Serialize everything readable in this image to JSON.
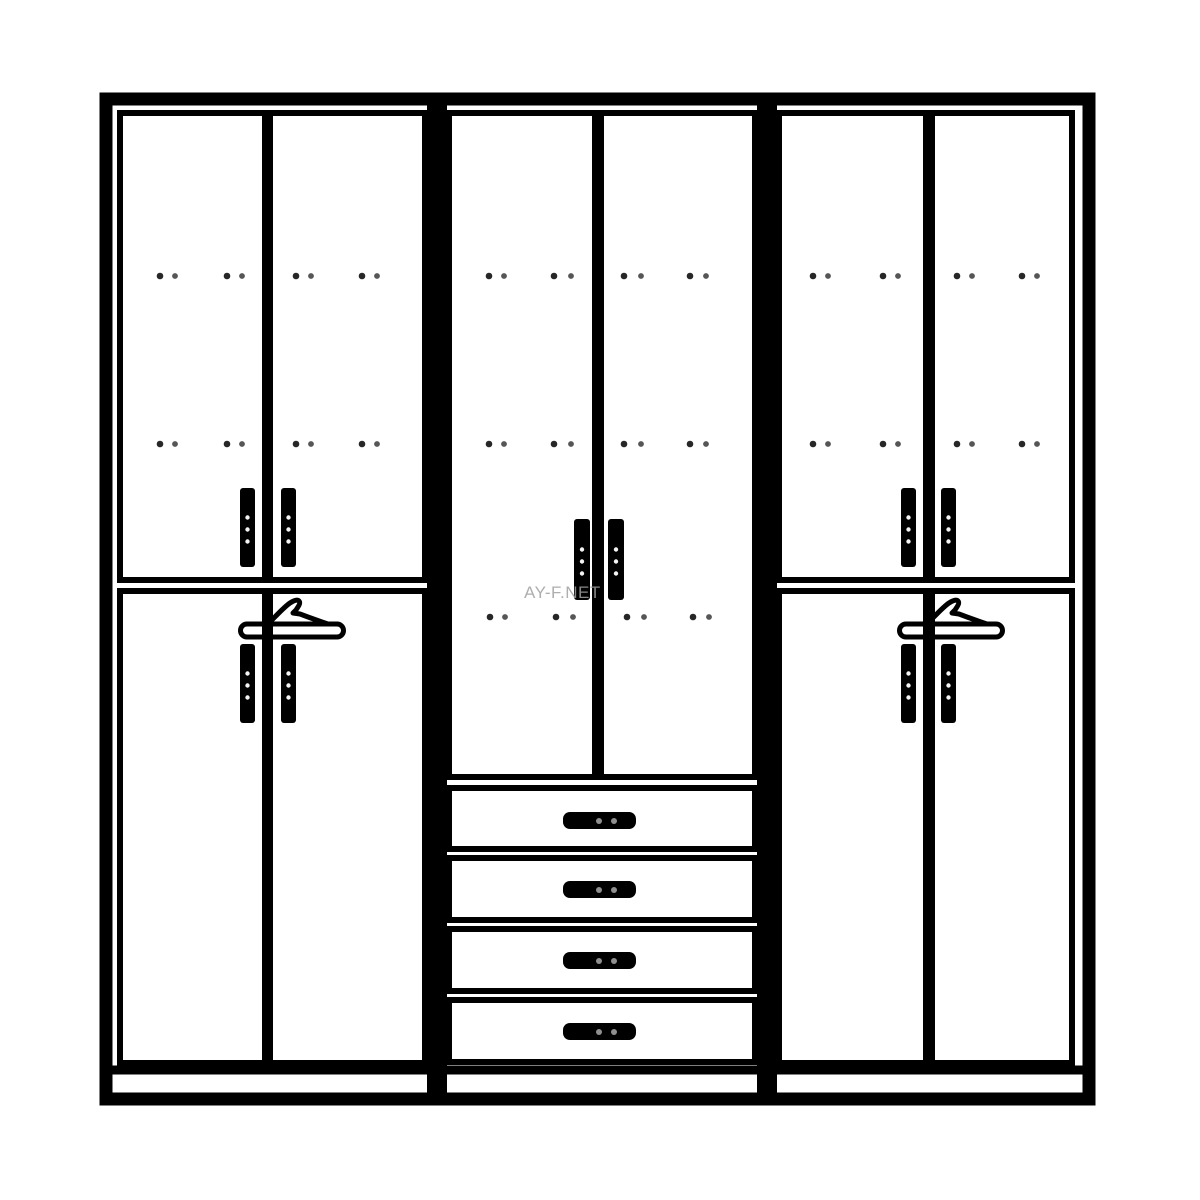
{
  "watermark": {
    "text": "AY-F.NET",
    "x": 524,
    "y": 584,
    "font_size": 17,
    "color": "#a0a0a0"
  },
  "colors": {
    "background": "#ffffff",
    "line": "#000000",
    "hinge_dot": "#151515",
    "handle_dot_light": "#f4f4f4",
    "drawer_handle_dot": "#8f8f8f"
  },
  "diagram": {
    "type": "wardrobe-front-elevation",
    "canvas": {
      "width": 1200,
      "height": 1200
    },
    "frame": {
      "name": "outer-frame",
      "x": 106,
      "y": 99,
      "w": 983,
      "h": 1000,
      "sw": 13
    },
    "dividers": [
      {
        "name": "section-divider-left",
        "x": 427,
        "y": 99,
        "w": 20,
        "h": 1000
      },
      {
        "name": "section-divider-right",
        "x": 757,
        "y": 99,
        "w": 20,
        "h": 1000
      }
    ],
    "plinth": {
      "name": "plinth-top-line",
      "x1": 106,
      "x2": 1089,
      "y": 1070,
      "sw": 9
    },
    "door_stroke": 6,
    "doors": [
      {
        "name": "door-left-upper-left",
        "x": 120,
        "y": 113,
        "w": 145,
        "h": 467
      },
      {
        "name": "door-left-upper-right",
        "x": 270,
        "y": 113,
        "w": 155,
        "h": 467
      },
      {
        "name": "door-left-lower-left",
        "x": 120,
        "y": 591,
        "w": 145,
        "h": 472
      },
      {
        "name": "door-left-lower-right",
        "x": 270,
        "y": 591,
        "w": 155,
        "h": 472
      },
      {
        "name": "door-middle-left",
        "x": 449,
        "y": 113,
        "w": 146,
        "h": 664
      },
      {
        "name": "door-middle-right",
        "x": 601,
        "y": 113,
        "w": 154,
        "h": 664
      },
      {
        "name": "door-right-upper-left",
        "x": 779,
        "y": 113,
        "w": 147,
        "h": 467
      },
      {
        "name": "door-right-upper-right",
        "x": 932,
        "y": 113,
        "w": 140,
        "h": 467
      },
      {
        "name": "door-right-lower-left",
        "x": 779,
        "y": 591,
        "w": 147,
        "h": 472
      },
      {
        "name": "door-right-lower-right",
        "x": 932,
        "y": 591,
        "w": 140,
        "h": 472
      }
    ],
    "drawers": [
      {
        "name": "drawer-1",
        "x": 449,
        "y": 788,
        "w": 306,
        "h": 61
      },
      {
        "name": "drawer-2",
        "x": 449,
        "y": 858,
        "w": 306,
        "h": 62
      },
      {
        "name": "drawer-3",
        "x": 449,
        "y": 929,
        "w": 306,
        "h": 62
      },
      {
        "name": "drawer-4",
        "x": 449,
        "y": 1000,
        "w": 306,
        "h": 62
      }
    ],
    "door_handles": [
      {
        "name": "handle-left-upper-door-left",
        "x": 240,
        "y": 488,
        "w": 15,
        "h": 79
      },
      {
        "name": "handle-left-upper-door-right",
        "x": 281,
        "y": 488,
        "w": 15,
        "h": 79
      },
      {
        "name": "handle-left-lower-door-left",
        "x": 240,
        "y": 644,
        "w": 15,
        "h": 79
      },
      {
        "name": "handle-left-lower-door-right",
        "x": 281,
        "y": 644,
        "w": 15,
        "h": 79
      },
      {
        "name": "handle-middle-door-left",
        "x": 574,
        "y": 519,
        "w": 16,
        "h": 81
      },
      {
        "name": "handle-middle-door-right",
        "x": 608,
        "y": 519,
        "w": 16,
        "h": 81
      },
      {
        "name": "handle-right-upper-door-left",
        "x": 901,
        "y": 488,
        "w": 15,
        "h": 79
      },
      {
        "name": "handle-right-upper-door-right",
        "x": 941,
        "y": 488,
        "w": 15,
        "h": 79
      },
      {
        "name": "handle-right-lower-door-left",
        "x": 901,
        "y": 644,
        "w": 15,
        "h": 79
      },
      {
        "name": "handle-right-lower-door-right",
        "x": 941,
        "y": 644,
        "w": 15,
        "h": 79
      }
    ],
    "drawer_handles": [
      {
        "name": "handle-drawer-1",
        "x": 563,
        "y": 812,
        "w": 73,
        "h": 17
      },
      {
        "name": "handle-drawer-2",
        "x": 563,
        "y": 881,
        "w": 73,
        "h": 17
      },
      {
        "name": "handle-drawer-3",
        "x": 563,
        "y": 952,
        "w": 73,
        "h": 17
      },
      {
        "name": "handle-drawer-4",
        "x": 563,
        "y": 1023,
        "w": 73,
        "h": 17
      }
    ],
    "hinge_dot_rows": [
      {
        "name": "hinge-dots-row-upper",
        "y": 276,
        "pairs": [
          [
            160,
            175
          ],
          [
            227,
            242
          ],
          [
            296,
            311
          ],
          [
            362,
            377
          ],
          [
            489,
            504
          ],
          [
            554,
            571
          ],
          [
            624,
            641
          ],
          [
            690,
            706
          ],
          [
            813,
            828
          ],
          [
            883,
            898
          ],
          [
            957,
            972
          ],
          [
            1022,
            1037
          ]
        ]
      },
      {
        "name": "hinge-dots-row-middle",
        "y": 444,
        "pairs": [
          [
            160,
            175
          ],
          [
            227,
            242
          ],
          [
            296,
            311
          ],
          [
            362,
            377
          ],
          [
            489,
            504
          ],
          [
            554,
            571
          ],
          [
            624,
            641
          ],
          [
            690,
            706
          ],
          [
            813,
            828
          ],
          [
            883,
            898
          ],
          [
            957,
            972
          ],
          [
            1022,
            1037
          ]
        ]
      },
      {
        "name": "hinge-dots-row-lower-center",
        "y": 617,
        "pairs": [
          [
            490,
            505
          ],
          [
            556,
            573
          ],
          [
            627,
            644
          ],
          [
            693,
            709
          ]
        ]
      }
    ],
    "hangers": [
      {
        "name": "hanger-icon-left",
        "x": 240,
        "y": 598
      },
      {
        "name": "hanger-icon-right",
        "x": 899,
        "y": 598
      }
    ],
    "hanger_shape": {
      "bar": "M7,26 H97 A6.5,6.5 0 0 1 97,39 H7 A6.5,6.5 0 0 1 7,26 Z",
      "bump": "M28,26 C36,18 44,9 50,5 C53,3 57,1 59,3 C61,5 58,9 56,12 L53,15 L60,16 L68,19 L82,24 L88,26",
      "stroke_width": 5
    }
  }
}
